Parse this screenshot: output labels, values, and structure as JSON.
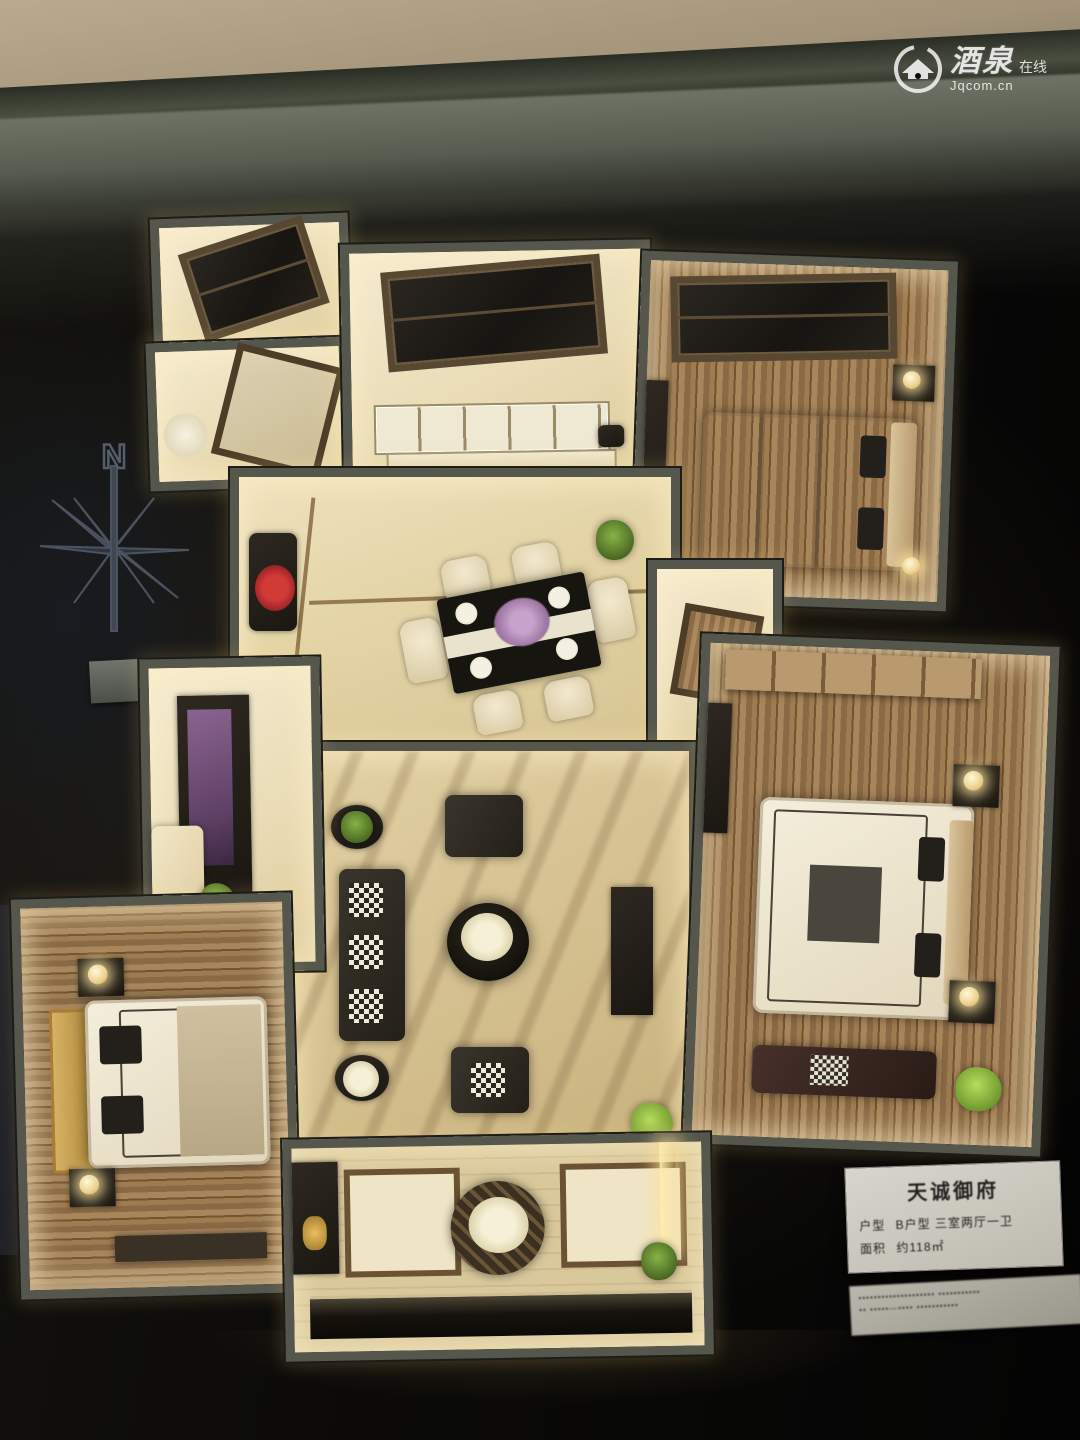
{
  "watermark": {
    "brand_cn": "酒泉",
    "brand_suffix": "在线",
    "domain": "Jqcom.cn"
  },
  "compass": {
    "north_label": "N"
  },
  "placard": {
    "title": "天诚御府",
    "rows": [
      {
        "label": "户型",
        "value": "B户型  三室两厅一卫"
      },
      {
        "label": "面积",
        "value": "约118㎡"
      }
    ],
    "footer": [
      "▪▪▪▪▪▪▪▪▪▪▪▪▪▪▪▪▪▪▪▪  ▪▪▪▪▪▪▪▪▪▪▪",
      "▪▪  ▪▪▪▪▪—▪▪▪▪  ▪▪▪▪▪▪▪▪▪▪▪"
    ]
  },
  "colors": {
    "glow_warm": "#ffe8b0",
    "wall_gray": "#55564c",
    "floor_cream": "#ead9b0",
    "wood_brown": "#9a7a52",
    "backdrop_black": "#0b0a08",
    "accent_red_flowers": "#d23a38",
    "accent_purple_flowers": "#9a72a0",
    "plant_green": "#86b247"
  }
}
